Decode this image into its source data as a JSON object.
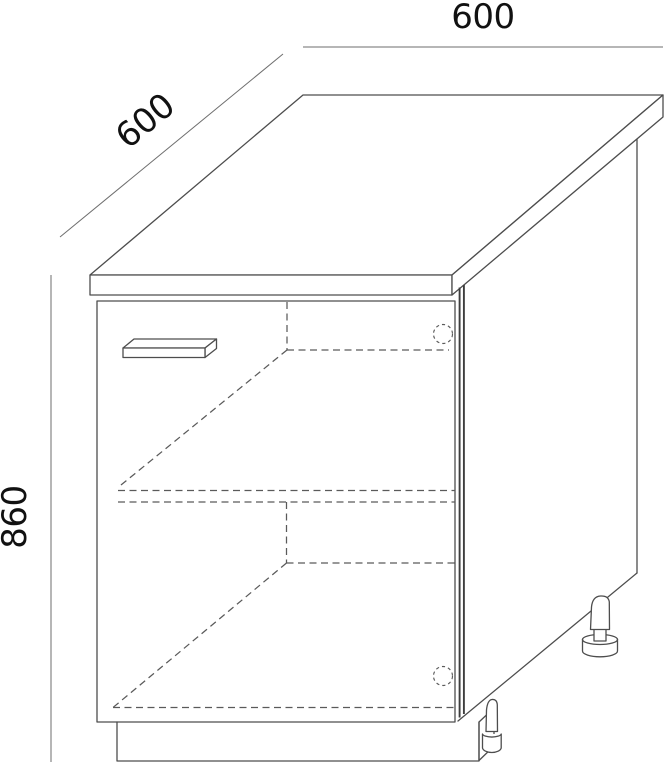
{
  "drawing": {
    "subject": "base-cabinet-isometric-line-drawing",
    "dimensions": {
      "width": "600",
      "depth": "600",
      "height": "860"
    },
    "colors": {
      "background": "#ffffff",
      "edges": "#4d4d4d",
      "hidden_lines": "#5a5a5a",
      "dimension_lines": "#6e6e6e",
      "text": "#111111"
    },
    "parts": [
      "countertop",
      "door",
      "door-handle",
      "side-panel",
      "plinth",
      "shelf-hidden",
      "bottom-panel-hidden",
      "hinge-cup-hole-top",
      "hinge-cup-hole-bottom",
      "adjustable-foot-rear",
      "adjustable-foot-front"
    ]
  }
}
